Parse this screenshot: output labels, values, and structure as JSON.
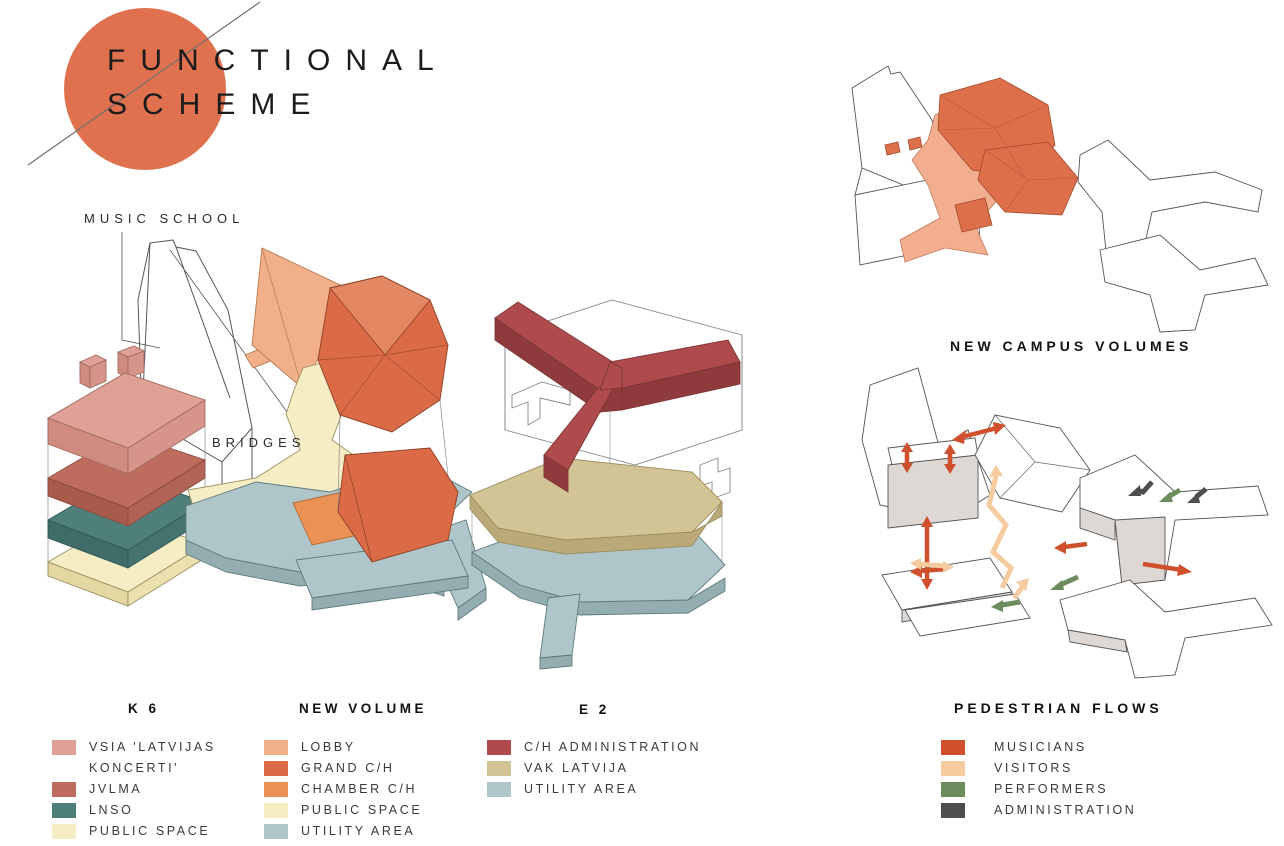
{
  "title": {
    "line1": "FUNCTIONAL",
    "line2": "SCHEME"
  },
  "annotations": {
    "music_school": "MUSIC SCHOOL",
    "bridges": "BRIDGES"
  },
  "panels": {
    "new_campus_volumes": "NEW CAMPUS VOLUMES",
    "pedestrian_flows": "PEDESTRIAN FLOWS"
  },
  "legends": {
    "k6": {
      "title": "K 6",
      "items": [
        {
          "label": "VSIA 'LATVIJAS\nKONCERTI'",
          "color": "#DFA095"
        },
        {
          "label": "JVLMA",
          "color": "#BE6C5D"
        },
        {
          "label": "LNSO",
          "color": "#4E7F7B"
        },
        {
          "label": "PUBLIC SPACE",
          "color": "#F6EDC4"
        }
      ]
    },
    "new_volume": {
      "title": "NEW VOLUME",
      "items": [
        {
          "label": "LOBBY",
          "color": "#F2B08A"
        },
        {
          "label": "GRAND C/H",
          "color": "#DB6A46"
        },
        {
          "label": "CHAMBER C/H",
          "color": "#EB9156"
        },
        {
          "label": "PUBLIC SPACE",
          "color": "#F6EDC4"
        },
        {
          "label": "UTILITY AREA",
          "color": "#AEC6C9"
        }
      ]
    },
    "e2": {
      "title": "E 2",
      "items": [
        {
          "label": "C/H ADMINISTRATION",
          "color": "#AF4B4D"
        },
        {
          "label": "VAK LATVIJA",
          "color": "#D2C494"
        },
        {
          "label": "UTILITY AREA",
          "color": "#AEC6C9"
        }
      ]
    },
    "pedestrian_flows": {
      "items": [
        {
          "label": "MUSICIANS",
          "color": "#D0502D"
        },
        {
          "label": "VISITORS",
          "color": "#F5CB9F"
        },
        {
          "label": "PERFORMERS",
          "color": "#6C8C5D"
        },
        {
          "label": "ADMINISTRATION",
          "color": "#4C4F4C"
        }
      ]
    }
  },
  "colors": {
    "accent_circle": "#E0714E",
    "vsia": "#DFA095",
    "jvlma": "#BE6C5D",
    "lnso": "#4E7F7B",
    "public_space": "#F6EDC4",
    "lobby": "#F2B08A",
    "grand_ch": "#DB6A46",
    "chamber_ch": "#EB9156",
    "utility": "#AEC6C9",
    "ch_admin": "#AF4B4D",
    "vak_latvija": "#D2C494",
    "campus_highlight": "#DD6F4B",
    "campus_plaza": "#F2AE8E",
    "musicians": "#D0502D",
    "visitors": "#F5CB9F",
    "performers": "#6C8C5D",
    "administration": "#4C4F4C"
  }
}
